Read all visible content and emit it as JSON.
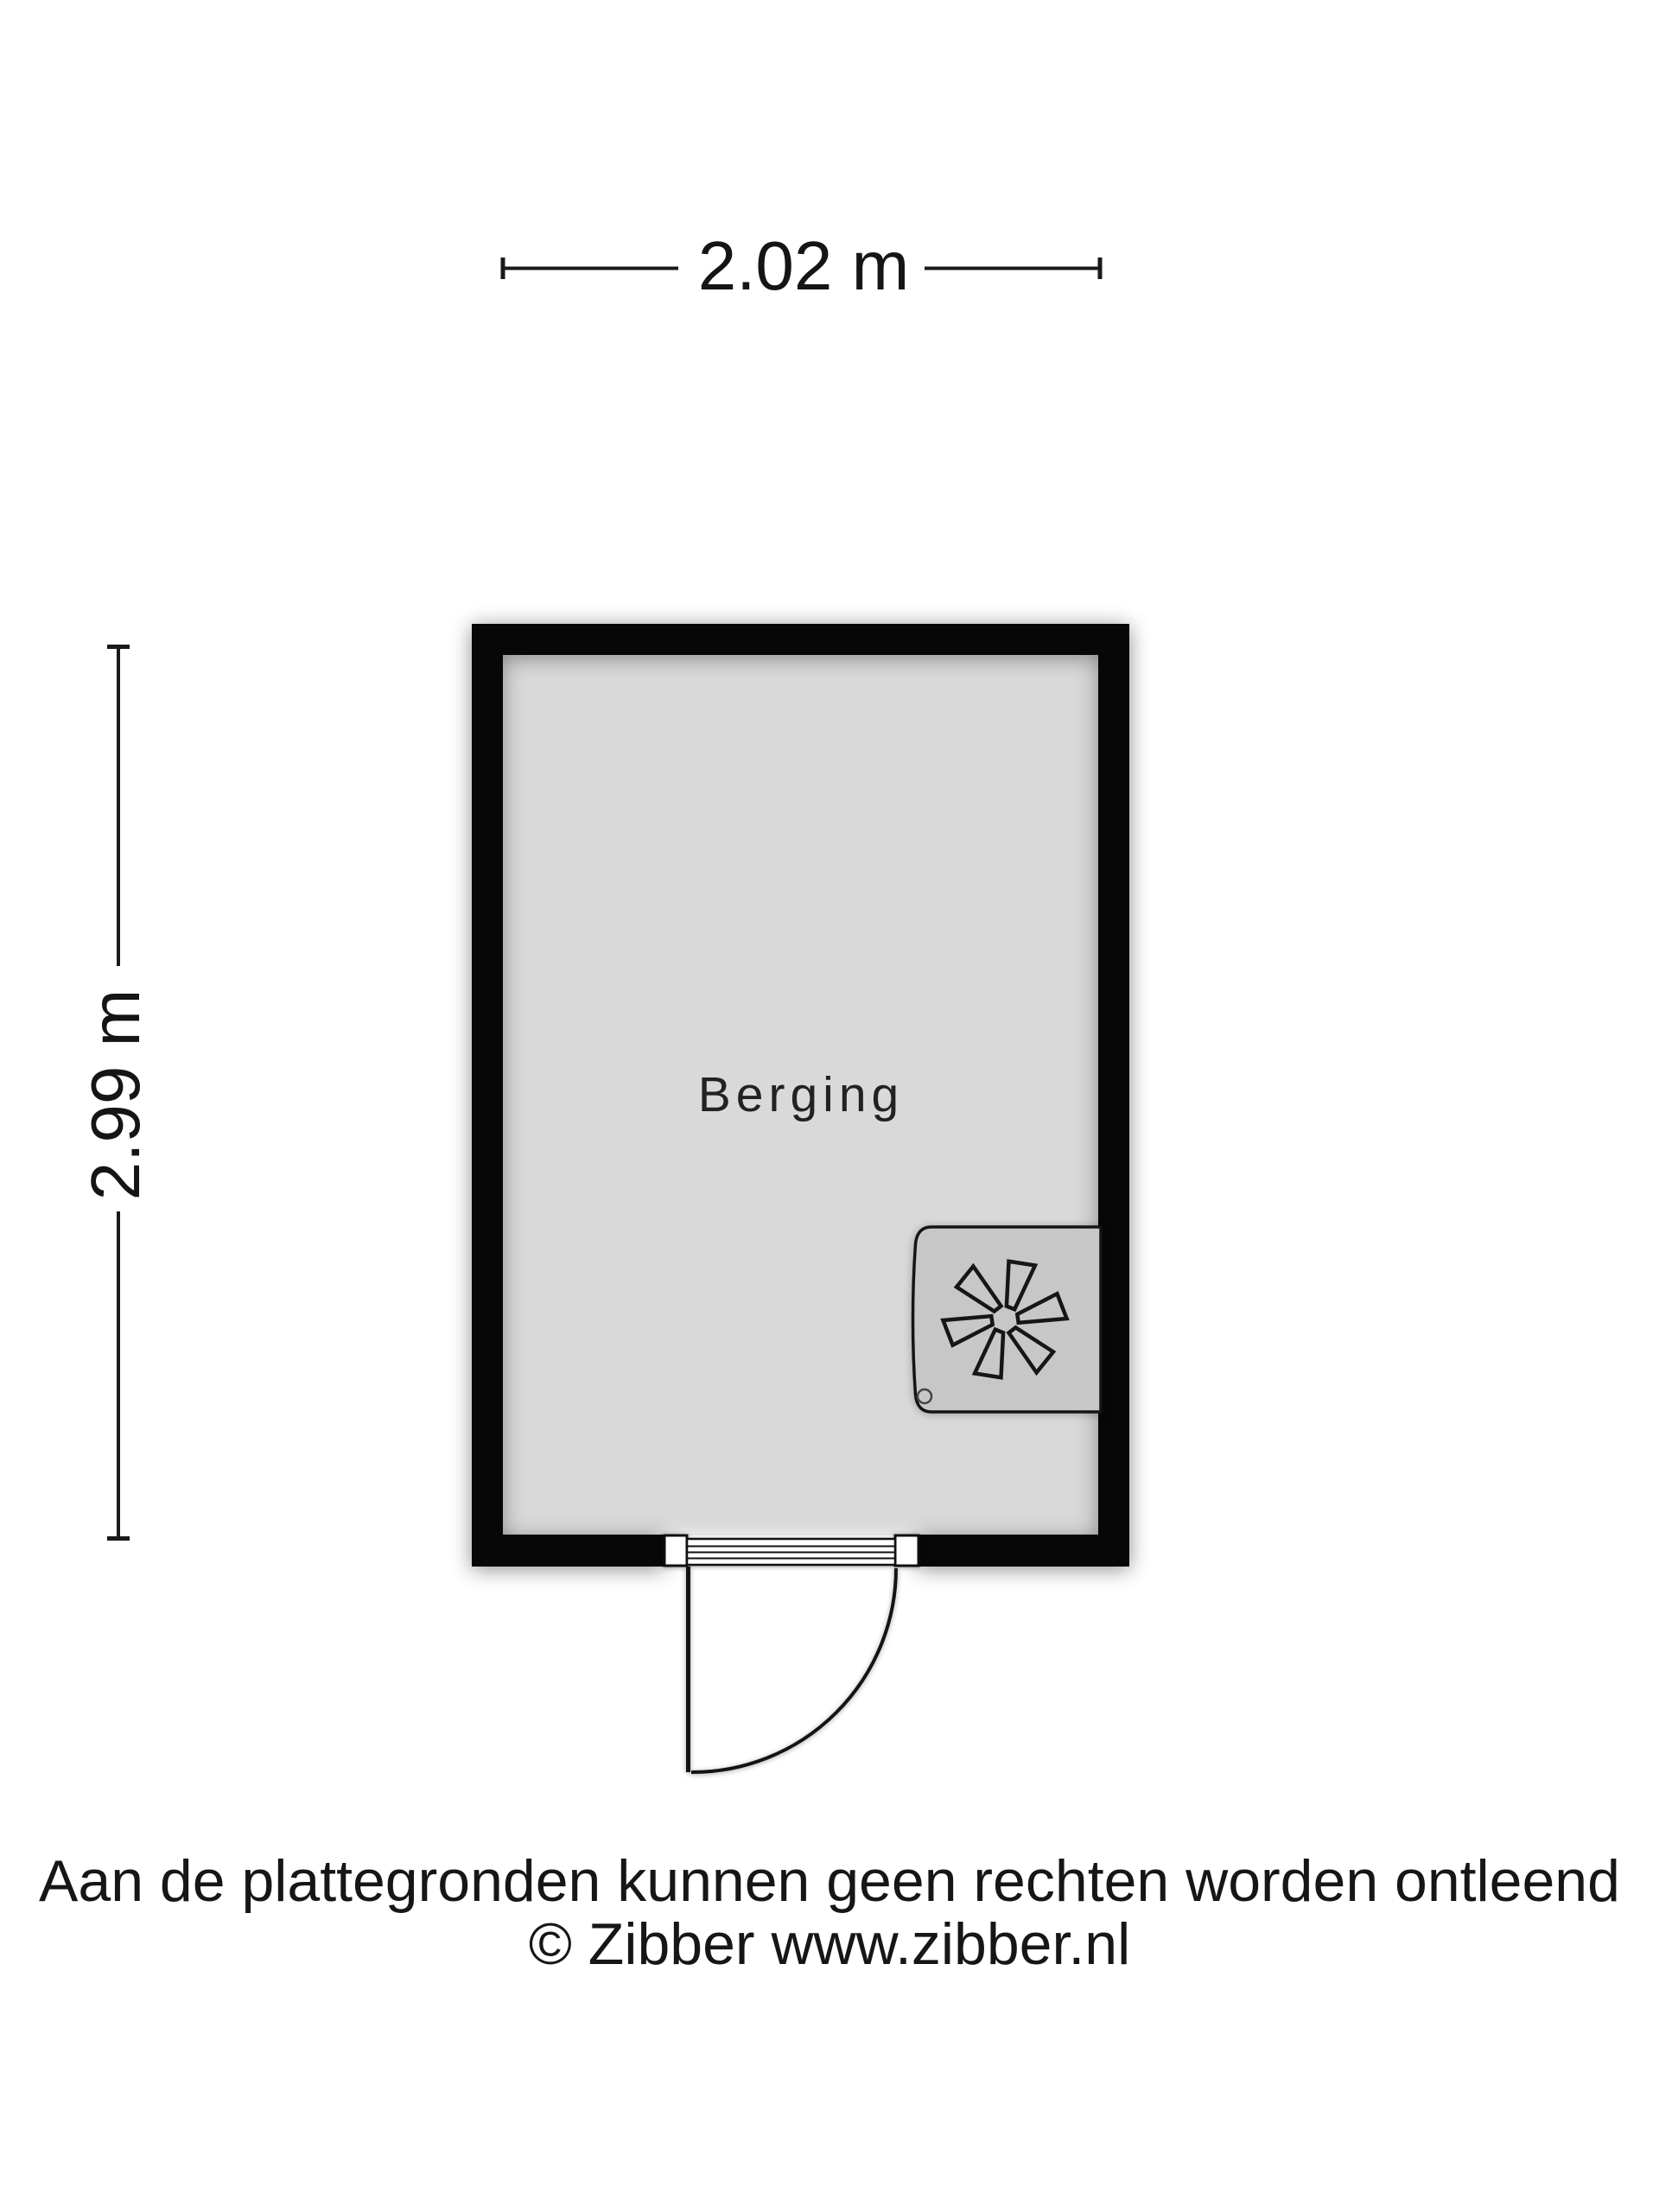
{
  "plan": {
    "room": {
      "label": "Berging"
    },
    "dimensions": {
      "width_label": "2.02 m",
      "height_label": "2.99 m"
    },
    "icons": {
      "fan": "fan-icon"
    }
  },
  "footer": {
    "disclaimer": "Aan de plattegronden kunnen geen rechten worden ontleend",
    "copyright": "© Zibber www.zibber.nl"
  },
  "colors": {
    "wall": "#070707",
    "floor": "#d9d9d9",
    "unit_fill": "#c7c7c7",
    "line": "#111111",
    "text": "#161616",
    "background": "#ffffff"
  }
}
